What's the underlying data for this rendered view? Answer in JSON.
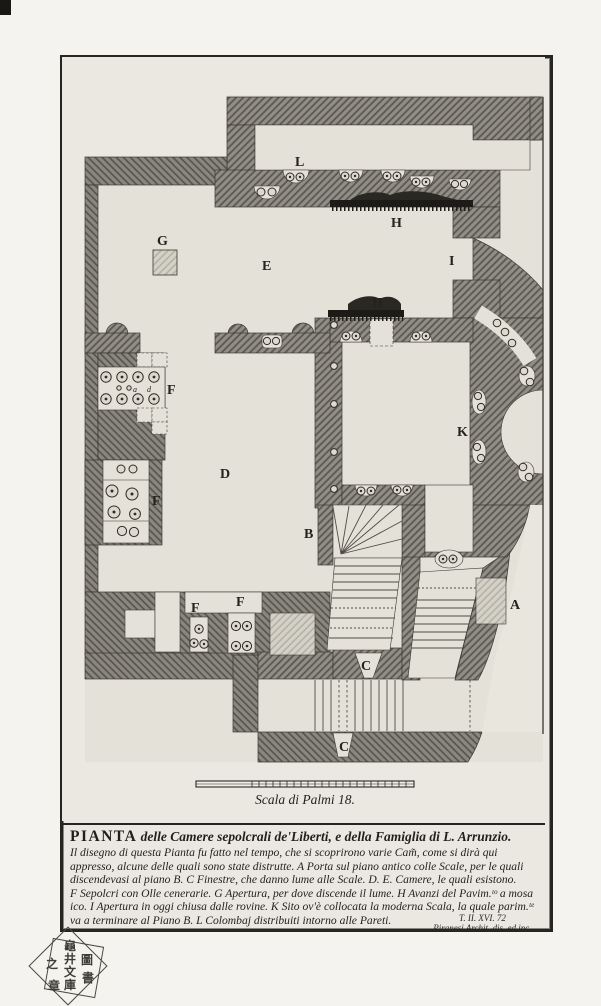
{
  "colors": {
    "paper": "#eae8e1",
    "floor": "#e4e1d8",
    "ink": "#26241e",
    "wall_base": "#918e85",
    "wall_line": "#5b5851",
    "mosaic": "#1c1b18"
  },
  "plate": {
    "volume_label": "Tom II.",
    "plate_number": "57.VIII",
    "scale_label": "Scala di Palmi 18.",
    "signature_ref": "T. II. XVI. 72",
    "signature_artist": "Piranesi Archit. dis. ed inc."
  },
  "plan": {
    "labels": [
      "L",
      "H",
      "G",
      "E",
      "I",
      "H",
      "F",
      "D",
      "K",
      "B",
      "F",
      "F",
      "F",
      "A",
      "C",
      "C",
      "a",
      "d"
    ]
  },
  "caption": {
    "title_word": "PIANTA",
    "title_rest": " delle Camere sepolcrali de'Liberti, e della Famiglia di L. Arrunzio.",
    "lines": [
      "Il disegno di questa Pianta fu fatto nel tempo, che si scoprirono varie Cam̃, come si dirà qui",
      "appresso, alcune delle quali sono state distrutte. A Porta sul piano antico colle Scale, per le quali",
      "discendevasi al piano B. C Finestre, che danno lume alle Scale. D. E. Camere, le quali esistono.",
      "F Sepolcri con Olle cenerarie. G Apertura, per dove discende il lume. H Avanzi del Pavim.ᵗᵒ a mosa",
      "ico. I Apertura in oggi chiusa dalle rovine. K Sito ov'è collocata la moderna Scala, la quale parim.ᵗᵉ",
      "va a terminare al Piano B. L Colombaj distribuiti intorno alle Pareti."
    ]
  },
  "stamp": {
    "center": [
      "龜",
      "井",
      "文",
      "庫"
    ],
    "left": "之",
    "bottom": "章",
    "right_top": "圖",
    "right_bottom": "書"
  }
}
